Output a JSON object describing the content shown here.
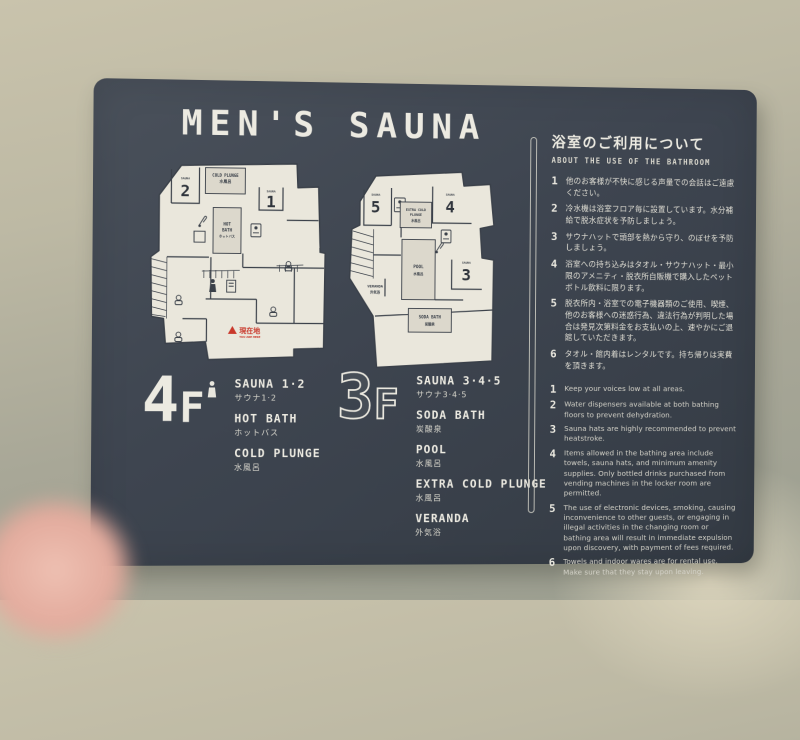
{
  "sign": {
    "title": "MEN'S SAUNA",
    "floors": [
      {
        "digit": "4",
        "suffix": "F",
        "legend": [
          {
            "en": "SAUNA 1·2",
            "jp": "サウナ1·2"
          },
          {
            "en": "HOT BATH",
            "jp": "ホットバス"
          },
          {
            "en": "COLD PLUNGE",
            "jp": "水風呂"
          }
        ]
      },
      {
        "digit": "3",
        "suffix": "F",
        "legend": [
          {
            "en": "SAUNA 3·4·5",
            "jp": "サウナ3·4·5"
          },
          {
            "en": "SODA BATH",
            "jp": "炭酸泉"
          },
          {
            "en": "POOL",
            "jp": "水風呂"
          },
          {
            "en": "EXTRA COLD PLUNGE",
            "jp": "水風呂"
          },
          {
            "en": "VERANDA",
            "jp": "外気浴"
          }
        ]
      }
    ],
    "map_labels": {
      "sauna_room_caption": "SAUNA",
      "room_numbers": [
        "1",
        "2",
        "3",
        "4",
        "5"
      ],
      "cold_plunge": {
        "en": "COLD PLUNGE",
        "jp": "水風呂"
      },
      "hot_bath": {
        "en1": "HOT",
        "en2": "BATH",
        "jp": "ホットバス"
      },
      "extra_cold_plunge": {
        "en1": "EXTRA COLD",
        "en2": "PLUNGE",
        "jp": "水風呂"
      },
      "pool": {
        "en": "POOL",
        "jp": "水風呂"
      },
      "soda_bath": {
        "en": "SODA BATH",
        "jp": "炭酸泉"
      },
      "veranda": {
        "en": "VERANDA",
        "jp": "外気浴"
      },
      "current_location": {
        "jp": "現在地",
        "en": "YOU ARE HERE"
      }
    },
    "panel": {
      "title_jp": "浴室のご利用について",
      "title_en": "ABOUT THE USE OF THE BATHROOM",
      "rules_jp": [
        {
          "num": "1",
          "text": "他のお客様が不快に感じる声量での会話はご遠慮ください。"
        },
        {
          "num": "2",
          "text": "冷水機は浴室フロア毎に設置しています。水分補給で脱水症状を予防しましょう。"
        },
        {
          "num": "3",
          "text": "サウナハットで頭部を熱から守り、のぼせを予防しましょう。"
        },
        {
          "num": "4",
          "text": "浴室への持ち込みはタオル・サウナハット・最小限のアメニティ・脱衣所自販機で購入したペットボトル飲料に限ります。"
        },
        {
          "num": "5",
          "text": "脱衣所内・浴室での電子機器類のご使用、喫煙、他のお客様への迷惑行為、違法行為が判明した場合は発見次第料金をお支払いの上、速やかにご退館していただきます。"
        },
        {
          "num": "6",
          "text": "タオル・館内着はレンタルです。持ち帰りは実費を頂きます。"
        }
      ],
      "rules_en": [
        {
          "num": "1",
          "text": "Keep your voices low at all areas."
        },
        {
          "num": "2",
          "text": "Water dispensers available at both bathing floors to prevent dehydration."
        },
        {
          "num": "3",
          "text": "Sauna hats are highly recommended to prevent heatstroke."
        },
        {
          "num": "4",
          "text": "Items allowed in the bathing area include towels, sauna hats, and minimum amenity supplies. Only bottled drinks purchased from vending machines in the locker room are permitted."
        },
        {
          "num": "5",
          "text": "The use of electronic devices, smoking, causing inconvenience to other guests, or engaging in illegal activities in the changing room or bathing area will result in immediate expulsion upon discovery, with payment of fees required."
        },
        {
          "num": "6",
          "text": "Towels and indoor wares are for rental use. Make sure that they stay upon leaving."
        }
      ]
    },
    "colors": {
      "board": "#3e4550",
      "board_text": "#e9e7de",
      "map_floor": "#eae7dc",
      "map_line": "#3a4049",
      "marker_red": "#c9382b",
      "wall": "#b3b0a0"
    }
  }
}
